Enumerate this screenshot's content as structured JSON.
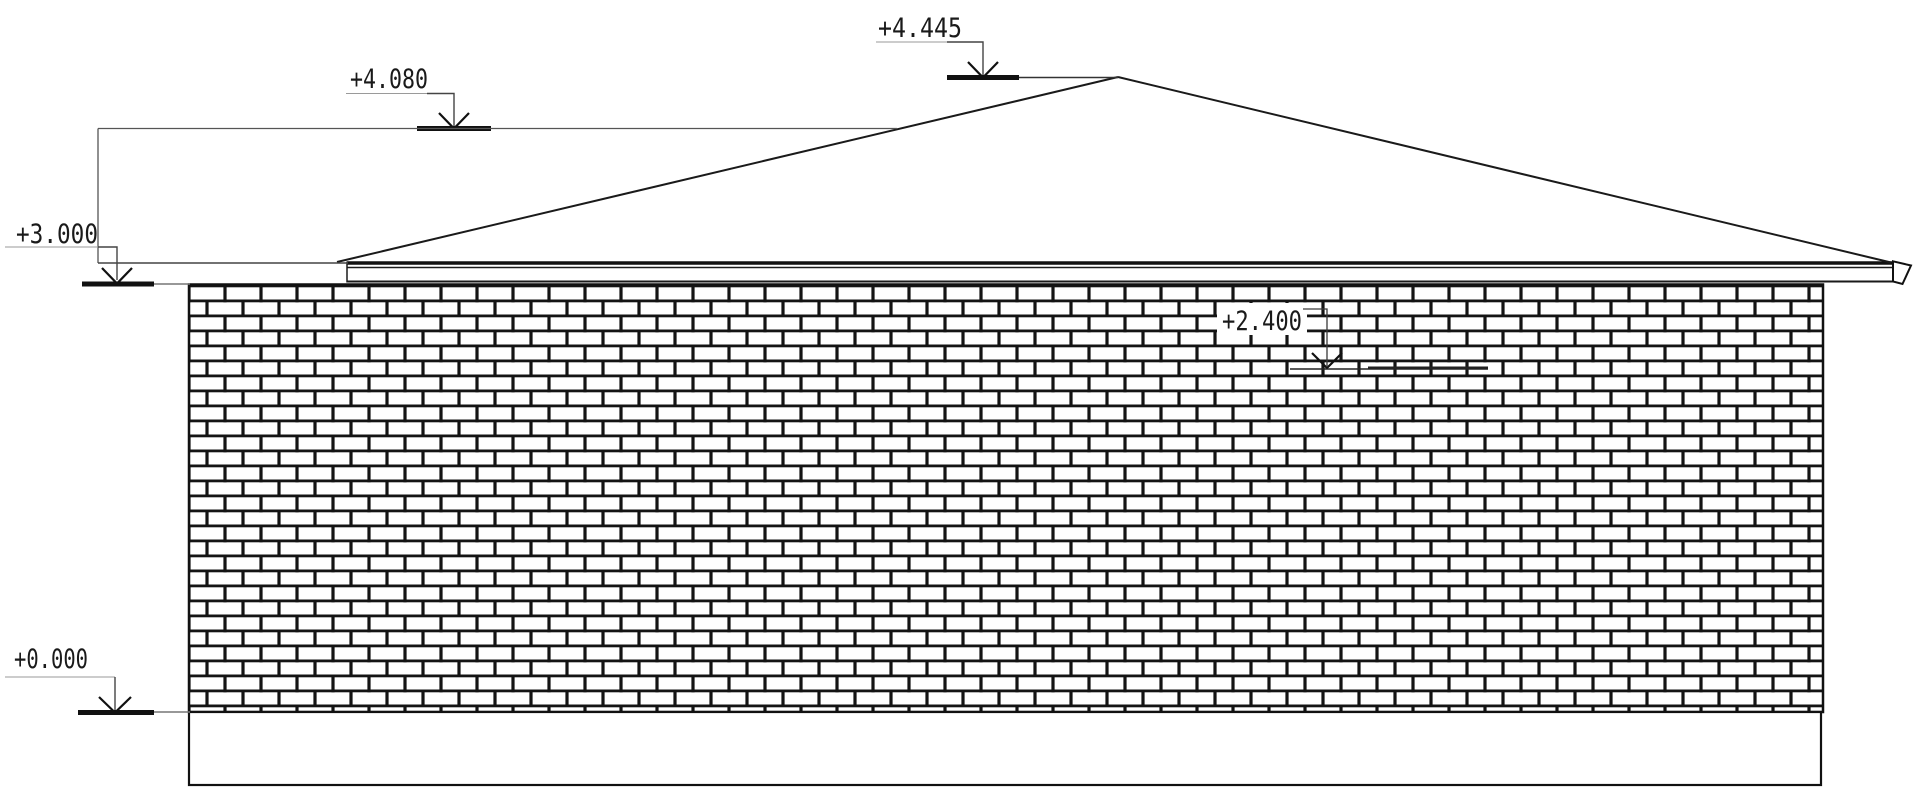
{
  "drawing": {
    "kind": "building-elevation",
    "background_color": "#ffffff",
    "line_color": "#1a1a1a",
    "levels": [
      {
        "id": "ridge",
        "label": "+4.445"
      },
      {
        "id": "roof-upper",
        "label": "+4.080"
      },
      {
        "id": "eave",
        "label": "+3.000"
      },
      {
        "id": "wall-mid",
        "label": "+2.400"
      },
      {
        "id": "ground",
        "label": "+0.000"
      }
    ]
  }
}
